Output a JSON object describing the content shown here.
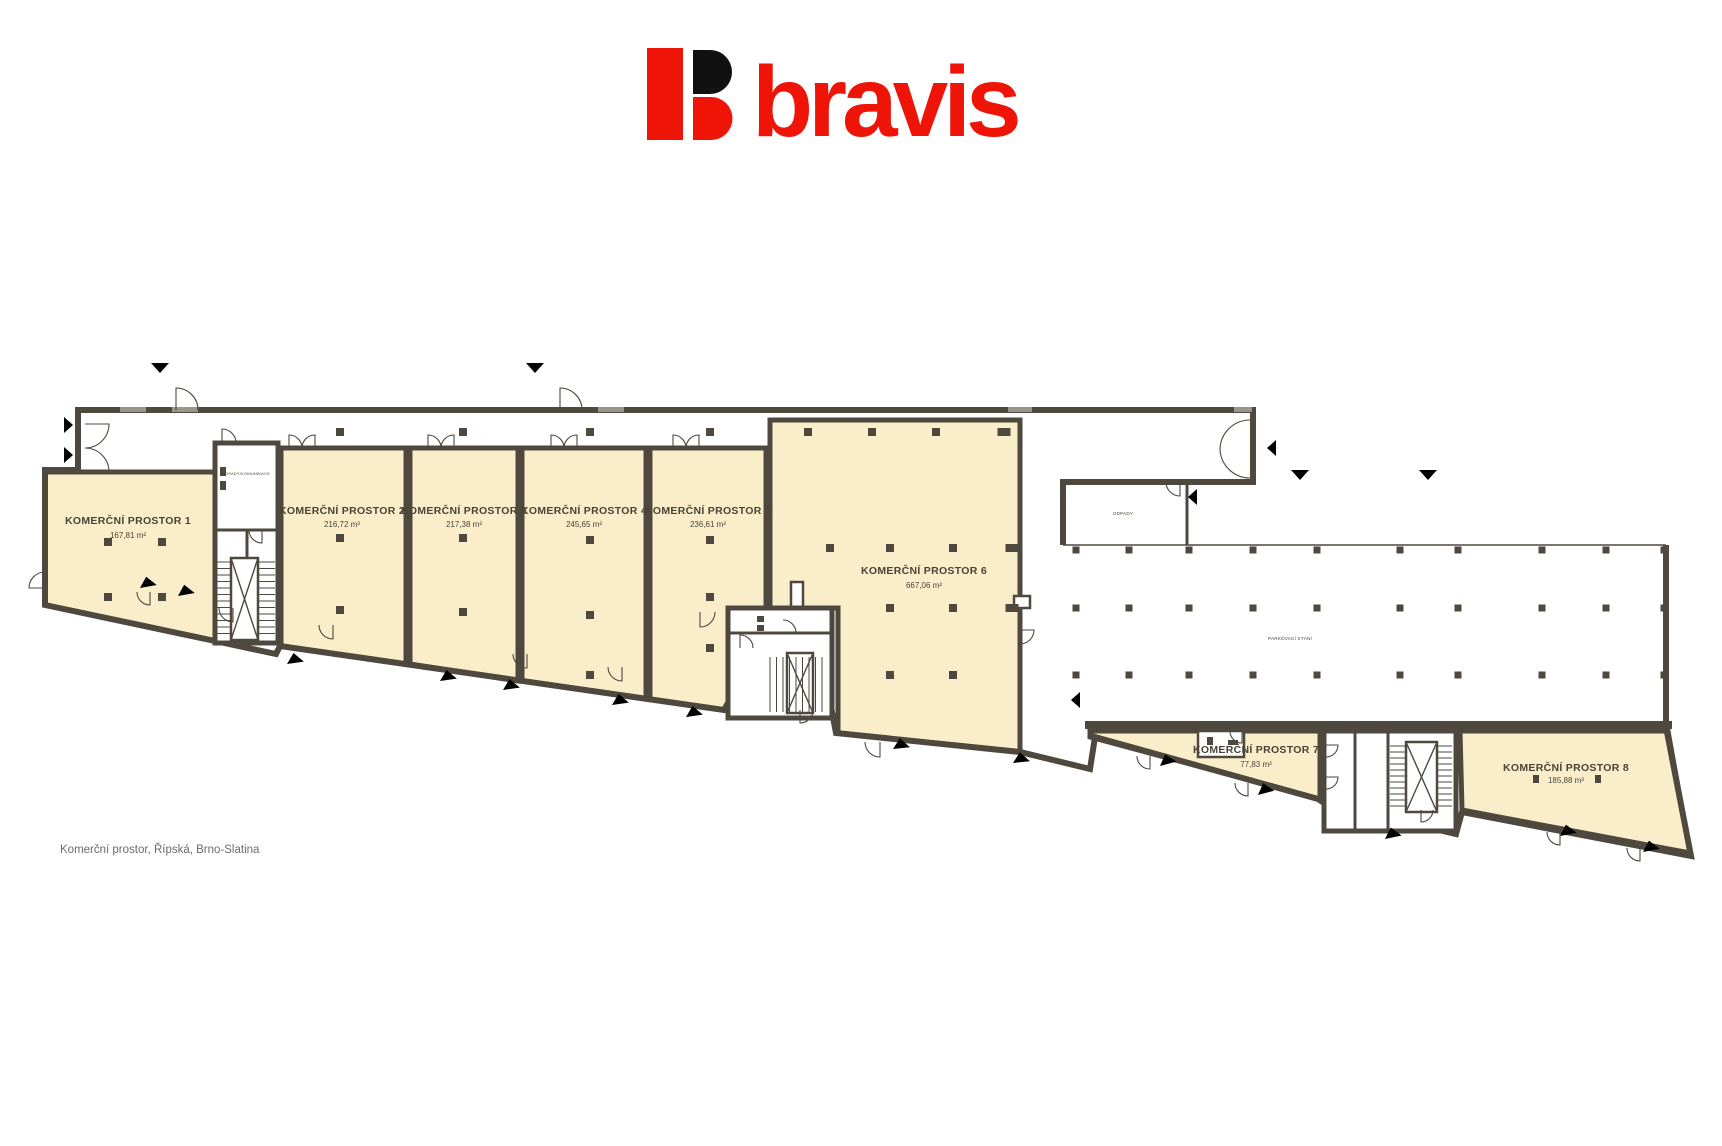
{
  "brand": {
    "name": "bravis"
  },
  "caption": "Komerční prostor, Řípská, Brno-Slatina",
  "plan": {
    "rooms": [
      {
        "name": "KOMERČNÍ PROSTOR 1",
        "area": "167,81 m²"
      },
      {
        "name": "KOMERČNÍ PROSTOR 2",
        "area": "216,72 m²"
      },
      {
        "name": "KOMERČNÍ PROSTOR 3",
        "area": "217,38 m²"
      },
      {
        "name": "KOMERČNÍ PROSTOR 4",
        "area": "245,65 m²"
      },
      {
        "name": "KOMERČNÍ PROSTOR 5",
        "area": "236,61 m²"
      },
      {
        "name": "KOMERČNÍ PROSTOR 6",
        "area": "667,06 m²"
      },
      {
        "name": "KOMERČNÍ PROSTOR 7",
        "area": "77,83 m²"
      },
      {
        "name": "KOMERČNÍ PROSTOR 8",
        "area": "185,88 m²"
      }
    ],
    "labels": {
      "parking": "PARKOVACÍ STÁNÍ",
      "waste": "ODPADY",
      "waste_room": "ODPADY/KOMUNIKACE"
    }
  },
  "colors": {
    "brand_red": "#ee1408",
    "brand_black": "#111111",
    "wall": "#4e483f",
    "room_fill": "#faeeca",
    "caption_gray": "#6b6b6b"
  }
}
